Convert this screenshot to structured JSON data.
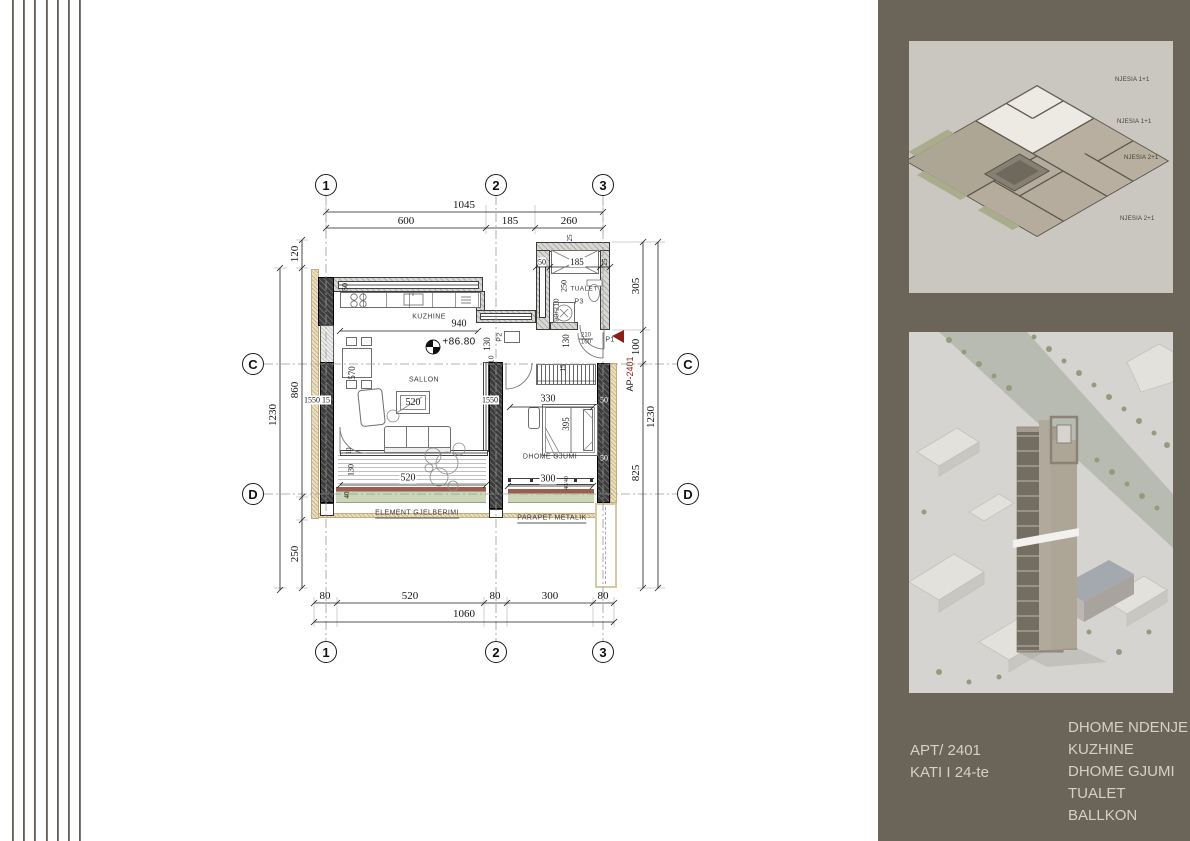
{
  "drawing": {
    "grid": {
      "cols": [
        "1",
        "2",
        "3"
      ],
      "rows": [
        "C",
        "D"
      ]
    },
    "dims": {
      "top_total": "1045",
      "top_a": "600",
      "top_b": "185",
      "top_c": "260",
      "left_a": "120",
      "left_b": "860",
      "left_total": "1230",
      "left_c": "250",
      "right_a": "305",
      "right_b": "100",
      "right_total": "1230",
      "right_c": "825",
      "bot_a": "80",
      "bot_b": "520",
      "bot_c": "80",
      "bot_d": "300",
      "bot_e": "80",
      "bot_total": "1060",
      "kitchen_w": "940",
      "k130a": "130",
      "k130b": "130",
      "dining": "570",
      "tv": "520",
      "balc_l": "520",
      "balc_l_d": "130",
      "balc_l_s": "40",
      "balc_l_g": "10",
      "balc_r": "300",
      "balc_r_s": "40/40",
      "bed_w": "330",
      "bed_l": "395",
      "win_l": "1550 15",
      "win_m": "1550",
      "wall_r1": "50",
      "wall_r2": "50",
      "wc_a": "50",
      "wc_b": "185",
      "wc_c": "25",
      "wc_d": "25",
      "wc_e": "250",
      "counter": "50",
      "ward": "15"
    },
    "rooms": {
      "kitchen": "KUZHINE",
      "living": "SALLON",
      "bedroom": "DHOME GJUMI",
      "wc": "TUALET"
    },
    "notes": {
      "level": "+86.80",
      "green": "ELEMENT GJELBERIMI",
      "parapet": "PARAPET METALIK"
    },
    "doors": {
      "apt_prefix": "AP-",
      "apt_num": "2401",
      "p1": "P1",
      "p1_size_a": "210",
      "p1_size_b": "100",
      "p2": "P2",
      "p2_size": "90/210",
      "p3": "P3",
      "p3_size": "90/210"
    },
    "accent_color": "#8a1f16"
  },
  "panel": {
    "bg_color": "#6a6459",
    "axon_labels": [
      "NJESIA 1+1",
      "NJESIA 1+1",
      "NJESIA 2+1",
      "NJESIA 2+1"
    ],
    "apt": "APT/ 2401",
    "floor": "KATI I 24-te",
    "rooms": [
      "DHOME NDENJE",
      "KUZHINE",
      "DHOME GJUMI",
      "TUALET",
      "BALLKON"
    ]
  }
}
